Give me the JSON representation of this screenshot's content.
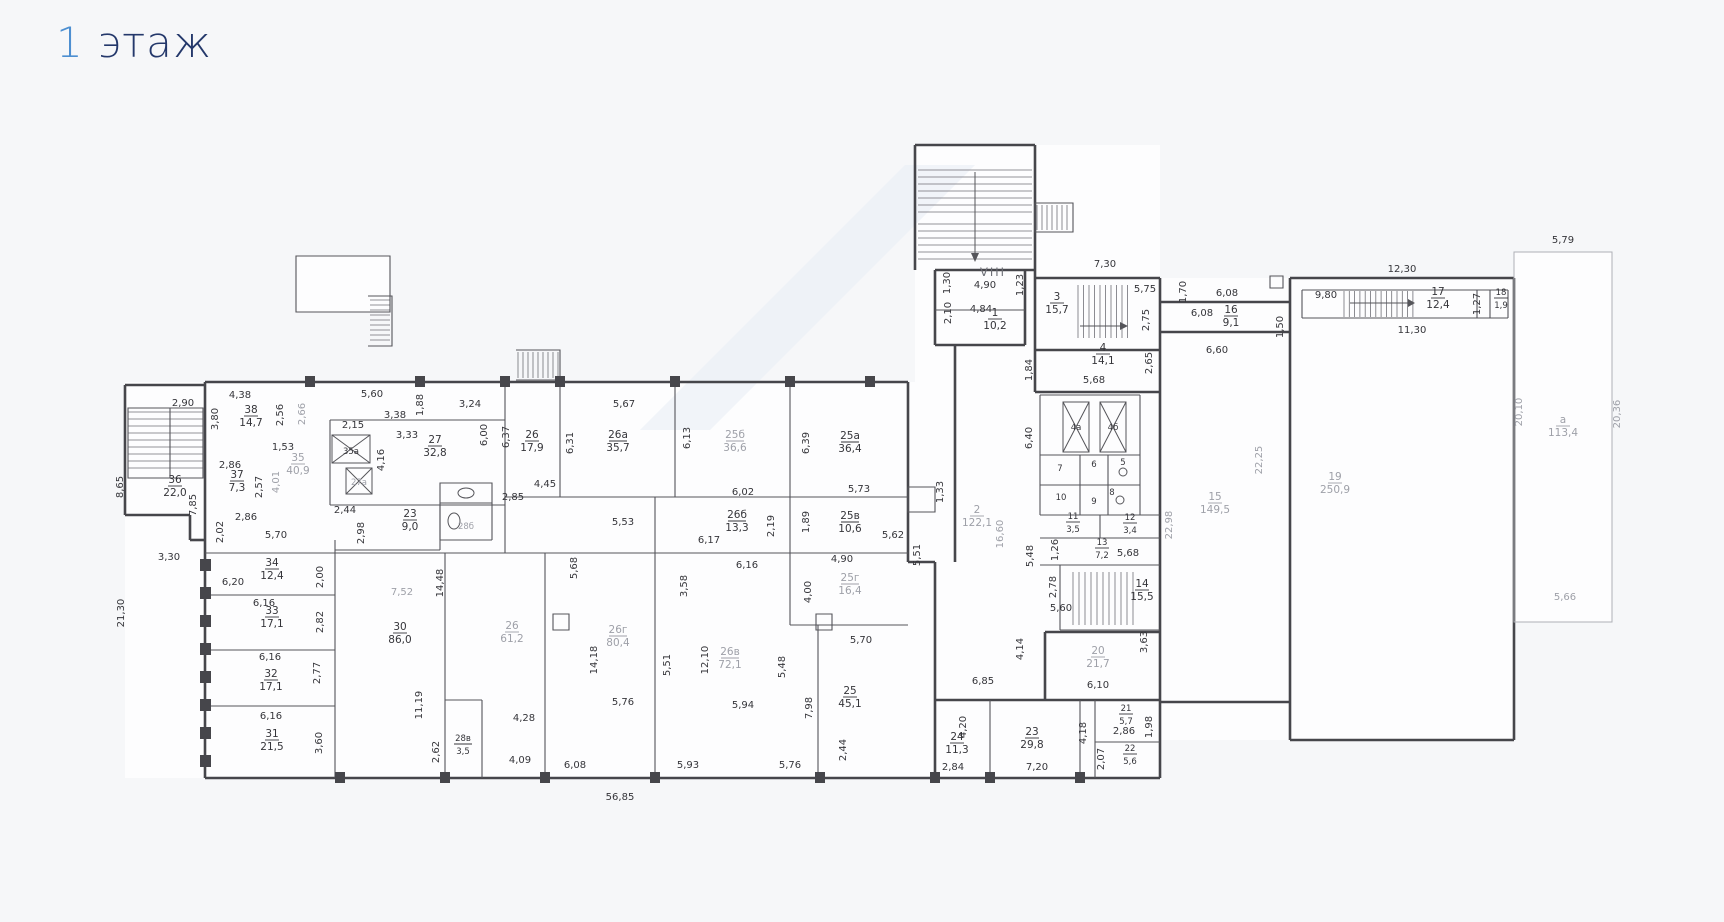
{
  "title": {
    "number": "1",
    "word": " этаж"
  },
  "colors": {
    "accent_blue": "#4d8fd1",
    "title_navy": "#24386b",
    "wall": "#46464b",
    "dim_text": "#35353a",
    "dim_text_light": "#9ea0a8"
  },
  "plan": {
    "rooms": [
      {
        "n": "36",
        "a": "22,0",
        "x": 175,
        "y": 483
      },
      {
        "n": "38",
        "a": "14,7",
        "x": 251,
        "y": 413
      },
      {
        "n": "37",
        "a": "7,3",
        "x": 237,
        "y": 478
      },
      {
        "n": "35",
        "a": "40,9",
        "x": 298,
        "y": 461,
        "l": 1
      },
      {
        "n": "35а",
        "a": null,
        "x": 351,
        "y": 454,
        "s": 1
      },
      {
        "n": "27а",
        "a": null,
        "x": 359,
        "y": 485,
        "s": 1,
        "l": 1
      },
      {
        "n": "27",
        "a": "32,8",
        "x": 435,
        "y": 443
      },
      {
        "n": "23",
        "a": "9,0",
        "x": 410,
        "y": 517
      },
      {
        "n": "28б",
        "a": null,
        "x": 466,
        "y": 529,
        "s": 1,
        "l": 1
      },
      {
        "n": "26",
        "a": "17,9",
        "x": 532,
        "y": 438
      },
      {
        "n": "26а",
        "a": "35,7",
        "x": 618,
        "y": 438
      },
      {
        "n": "25б",
        "a": "36,6",
        "x": 735,
        "y": 438,
        "l": 1
      },
      {
        "n": "25а",
        "a": "36,4",
        "x": 850,
        "y": 439
      },
      {
        "n": "26б",
        "a": "13,3",
        "x": 737,
        "y": 518
      },
      {
        "n": "25в",
        "a": "10,6",
        "x": 850,
        "y": 519
      },
      {
        "n": "25г",
        "a": "16,4",
        "x": 850,
        "y": 581,
        "l": 1
      },
      {
        "n": "34",
        "a": "12,4",
        "x": 272,
        "y": 566
      },
      {
        "n": "33",
        "a": "17,1",
        "x": 272,
        "y": 614
      },
      {
        "n": "32",
        "a": "17,1",
        "x": 271,
        "y": 677
      },
      {
        "n": "31",
        "a": "21,5",
        "x": 272,
        "y": 737
      },
      {
        "n": "30",
        "a": "86,0",
        "x": 400,
        "y": 630
      },
      {
        "n": "26",
        "a": "61,2",
        "x": 512,
        "y": 629,
        "l": 1
      },
      {
        "n": "26г",
        "a": "80,4",
        "x": 618,
        "y": 633,
        "l": 1
      },
      {
        "n": "26в",
        "a": "72,1",
        "x": 730,
        "y": 655,
        "l": 1
      },
      {
        "n": "28в",
        "a": "3,5",
        "x": 463,
        "y": 741,
        "s": 1
      },
      {
        "n": "25",
        "a": "45,1",
        "x": 850,
        "y": 694
      },
      {
        "n": "1",
        "a": "10,2",
        "x": 995,
        "y": 316
      },
      {
        "n": "3",
        "a": "15,7",
        "x": 1057,
        "y": 300
      },
      {
        "n": "4",
        "a": "14,1",
        "x": 1103,
        "y": 351
      },
      {
        "n": "2",
        "a": "122,1",
        "x": 977,
        "y": 513,
        "l": 1
      },
      {
        "n": "4а",
        "a": null,
        "x": 1076,
        "y": 430,
        "s": 1
      },
      {
        "n": "4б",
        "a": null,
        "x": 1113,
        "y": 430,
        "s": 1
      },
      {
        "n": "7",
        "a": null,
        "x": 1060,
        "y": 471,
        "s": 1
      },
      {
        "n": "6",
        "a": null,
        "x": 1094,
        "y": 467,
        "s": 1
      },
      {
        "n": "5",
        "a": null,
        "x": 1123,
        "y": 465,
        "s": 1
      },
      {
        "n": "10",
        "a": null,
        "x": 1061,
        "y": 500,
        "s": 1
      },
      {
        "n": "9",
        "a": null,
        "x": 1094,
        "y": 504,
        "s": 1
      },
      {
        "n": "8",
        "a": null,
        "x": 1112,
        "y": 495,
        "s": 1
      },
      {
        "n": "11",
        "a": "3,5",
        "x": 1073,
        "y": 519,
        "s": 1
      },
      {
        "n": "12",
        "a": "3,4",
        "x": 1130,
        "y": 520,
        "s": 1
      },
      {
        "n": "13",
        "a": "7,2",
        "x": 1102,
        "y": 545,
        "s": 1
      },
      {
        "n": "14",
        "a": "15,5",
        "x": 1142,
        "y": 587
      },
      {
        "n": "20",
        "a": "21,7",
        "x": 1098,
        "y": 654,
        "l": 1
      },
      {
        "n": "24",
        "a": "11,3",
        "x": 957,
        "y": 740
      },
      {
        "n": "23",
        "a": "29,8",
        "x": 1032,
        "y": 735
      },
      {
        "n": "21",
        "a": "5,7",
        "x": 1126,
        "y": 711,
        "s": 1
      },
      {
        "n": "22",
        "a": "5,6",
        "x": 1130,
        "y": 751,
        "s": 1
      },
      {
        "n": "16",
        "a": "9,1",
        "x": 1231,
        "y": 313
      },
      {
        "n": "17",
        "a": "12,4",
        "x": 1438,
        "y": 295
      },
      {
        "n": "18",
        "a": "1,9",
        "x": 1501,
        "y": 295,
        "s": 1
      },
      {
        "n": "15",
        "a": "149,5",
        "x": 1215,
        "y": 500,
        "l": 1
      },
      {
        "n": "19",
        "a": "250,9",
        "x": 1335,
        "y": 480,
        "l": 1
      },
      {
        "n": "а",
        "a": "113,4",
        "x": 1563,
        "y": 423,
        "l": 1
      }
    ],
    "dims": [
      {
        "t": "2,90",
        "x": 183,
        "y": 406
      },
      {
        "t": "4,38",
        "x": 240,
        "y": 398
      },
      {
        "t": "3,80",
        "x": 218,
        "y": 419,
        "r": 1
      },
      {
        "t": "2,56",
        "x": 283,
        "y": 415,
        "r": 1
      },
      {
        "t": "2,66",
        "x": 305,
        "y": 414,
        "r": 1,
        "l": 1
      },
      {
        "t": "5,60",
        "x": 372,
        "y": 397
      },
      {
        "t": "3,38",
        "x": 395,
        "y": 418
      },
      {
        "t": "1,88",
        "x": 423,
        "y": 405,
        "r": 1
      },
      {
        "t": "3,24",
        "x": 470,
        "y": 407
      },
      {
        "t": "2,15",
        "x": 353,
        "y": 428
      },
      {
        "t": "3,33",
        "x": 407,
        "y": 438
      },
      {
        "t": "1,53",
        "x": 283,
        "y": 450
      },
      {
        "t": "2,86",
        "x": 230,
        "y": 468
      },
      {
        "t": "2,57",
        "x": 262,
        "y": 487,
        "r": 1
      },
      {
        "t": "4,01",
        "x": 279,
        "y": 482,
        "r": 1,
        "l": 1
      },
      {
        "t": "4,16",
        "x": 384,
        "y": 460,
        "r": 1
      },
      {
        "t": "8,65",
        "x": 123,
        "y": 487,
        "r": 1
      },
      {
        "t": "7,85",
        "x": 196,
        "y": 505,
        "r": 1
      },
      {
        "t": "2,02",
        "x": 223,
        "y": 532,
        "r": 1
      },
      {
        "t": "2,86",
        "x": 246,
        "y": 520
      },
      {
        "t": "5,70",
        "x": 276,
        "y": 538
      },
      {
        "t": "3,30",
        "x": 169,
        "y": 560
      },
      {
        "t": "21,30",
        "x": 124,
        "y": 613,
        "r": 1
      },
      {
        "t": "6,20",
        "x": 233,
        "y": 585
      },
      {
        "t": "2,00",
        "x": 323,
        "y": 577,
        "r": 1
      },
      {
        "t": "7,52",
        "x": 402,
        "y": 595,
        "l": 1
      },
      {
        "t": "6,16",
        "x": 264,
        "y": 606
      },
      {
        "t": "2,82",
        "x": 323,
        "y": 622,
        "r": 1
      },
      {
        "t": "6,16",
        "x": 270,
        "y": 660
      },
      {
        "t": "2,77",
        "x": 320,
        "y": 673,
        "r": 1
      },
      {
        "t": "6,16",
        "x": 271,
        "y": 719
      },
      {
        "t": "3,60",
        "x": 322,
        "y": 743,
        "r": 1
      },
      {
        "t": "2,44",
        "x": 345,
        "y": 513
      },
      {
        "t": "2,98",
        "x": 364,
        "y": 533,
        "r": 1
      },
      {
        "t": "6,00",
        "x": 487,
        "y": 435,
        "r": 1
      },
      {
        "t": "6,37",
        "x": 509,
        "y": 437,
        "r": 1
      },
      {
        "t": "2,85",
        "x": 513,
        "y": 500
      },
      {
        "t": "4,45",
        "x": 545,
        "y": 487
      },
      {
        "t": "5,67",
        "x": 624,
        "y": 407
      },
      {
        "t": "6,31",
        "x": 573,
        "y": 443,
        "r": 1
      },
      {
        "t": "6,13",
        "x": 690,
        "y": 438,
        "r": 1
      },
      {
        "t": "6,39",
        "x": 809,
        "y": 443,
        "r": 1
      },
      {
        "t": "6,02",
        "x": 743,
        "y": 495
      },
      {
        "t": "5,73",
        "x": 859,
        "y": 492
      },
      {
        "t": "5,53",
        "x": 623,
        "y": 525
      },
      {
        "t": "2,19",
        "x": 774,
        "y": 526,
        "r": 1
      },
      {
        "t": "1,89",
        "x": 809,
        "y": 522,
        "r": 1
      },
      {
        "t": "6,17",
        "x": 709,
        "y": 543
      },
      {
        "t": "5,62",
        "x": 893,
        "y": 538
      },
      {
        "t": "5,51",
        "x": 920,
        "y": 555,
        "r": 1
      },
      {
        "t": "4,90",
        "x": 842,
        "y": 562
      },
      {
        "t": "6,16",
        "x": 747,
        "y": 568
      },
      {
        "t": "4,00",
        "x": 811,
        "y": 592,
        "r": 1
      },
      {
        "t": "1,33",
        "x": 943,
        "y": 492,
        "r": 1
      },
      {
        "t": "14,48",
        "x": 443,
        "y": 583,
        "r": 1
      },
      {
        "t": "5,68",
        "x": 577,
        "y": 568,
        "r": 1
      },
      {
        "t": "3,58",
        "x": 687,
        "y": 586,
        "r": 1
      },
      {
        "t": "14,18",
        "x": 597,
        "y": 660,
        "r": 1
      },
      {
        "t": "5,51",
        "x": 670,
        "y": 665,
        "r": 1
      },
      {
        "t": "12,10",
        "x": 708,
        "y": 660,
        "r": 1
      },
      {
        "t": "5,48",
        "x": 785,
        "y": 667,
        "r": 1
      },
      {
        "t": "11,19",
        "x": 422,
        "y": 705,
        "r": 1
      },
      {
        "t": "4,28",
        "x": 524,
        "y": 721
      },
      {
        "t": "5,76",
        "x": 623,
        "y": 705
      },
      {
        "t": "5,94",
        "x": 743,
        "y": 708
      },
      {
        "t": "7,98",
        "x": 812,
        "y": 708,
        "r": 1
      },
      {
        "t": "2,62",
        "x": 439,
        "y": 752,
        "r": 1
      },
      {
        "t": "4,09",
        "x": 520,
        "y": 763
      },
      {
        "t": "6,08",
        "x": 575,
        "y": 768
      },
      {
        "t": "5,93",
        "x": 688,
        "y": 768
      },
      {
        "t": "5,76",
        "x": 790,
        "y": 768
      },
      {
        "t": "2,44",
        "x": 846,
        "y": 750,
        "r": 1
      },
      {
        "t": "56,85",
        "x": 620,
        "y": 800
      },
      {
        "t": "5,70",
        "x": 861,
        "y": 643
      },
      {
        "t": "6,85",
        "x": 983,
        "y": 684
      },
      {
        "t": "VIII",
        "x": 993,
        "y": 276,
        "b": 1
      },
      {
        "t": "1,30",
        "x": 950,
        "y": 283,
        "r": 1
      },
      {
        "t": "4,90",
        "x": 985,
        "y": 288
      },
      {
        "t": "1,23",
        "x": 1023,
        "y": 285,
        "r": 1
      },
      {
        "t": "2,10",
        "x": 951,
        "y": 313,
        "r": 1
      },
      {
        "t": "4,84",
        "x": 981,
        "y": 312
      },
      {
        "t": "7,30",
        "x": 1105,
        "y": 267
      },
      {
        "t": "5,75",
        "x": 1145,
        "y": 292
      },
      {
        "t": "2,75",
        "x": 1149,
        "y": 320,
        "r": 1
      },
      {
        "t": "2,65",
        "x": 1152,
        "y": 363,
        "r": 1
      },
      {
        "t": "5,68",
        "x": 1094,
        "y": 383
      },
      {
        "t": "1,84",
        "x": 1032,
        "y": 370,
        "r": 1
      },
      {
        "t": "6,40",
        "x": 1032,
        "y": 438,
        "r": 1
      },
      {
        "t": "16,60",
        "x": 1003,
        "y": 534,
        "r": 1,
        "l": 1
      },
      {
        "t": "5,48",
        "x": 1033,
        "y": 556,
        "r": 1
      },
      {
        "t": "1,26",
        "x": 1058,
        "y": 550,
        "r": 1
      },
      {
        "t": "5,68",
        "x": 1128,
        "y": 556
      },
      {
        "t": "2,78",
        "x": 1056,
        "y": 587,
        "r": 1
      },
      {
        "t": "5,60",
        "x": 1061,
        "y": 611
      },
      {
        "t": "4,14",
        "x": 1023,
        "y": 649,
        "r": 1
      },
      {
        "t": "3,63",
        "x": 1147,
        "y": 642,
        "r": 1
      },
      {
        "t": "6,10",
        "x": 1098,
        "y": 688
      },
      {
        "t": "4,20",
        "x": 966,
        "y": 727,
        "r": 1
      },
      {
        "t": "2,84",
        "x": 953,
        "y": 770
      },
      {
        "t": "7,20",
        "x": 1037,
        "y": 770
      },
      {
        "t": "4,18",
        "x": 1086,
        "y": 733,
        "r": 1
      },
      {
        "t": "2,86",
        "x": 1124,
        "y": 734
      },
      {
        "t": "1,98",
        "x": 1152,
        "y": 727,
        "r": 1
      },
      {
        "t": "2,07",
        "x": 1104,
        "y": 759,
        "r": 1
      },
      {
        "t": "1,70",
        "x": 1186,
        "y": 292,
        "r": 1
      },
      {
        "t": "6,08",
        "x": 1227,
        "y": 296
      },
      {
        "t": "6,08",
        "x": 1202,
        "y": 316
      },
      {
        "t": "1,50",
        "x": 1283,
        "y": 327,
        "r": 1
      },
      {
        "t": "6,60",
        "x": 1217,
        "y": 353
      },
      {
        "t": "12,30",
        "x": 1402,
        "y": 272
      },
      {
        "t": "9,80",
        "x": 1326,
        "y": 298
      },
      {
        "t": "1,27",
        "x": 1480,
        "y": 304,
        "r": 1
      },
      {
        "t": "11,30",
        "x": 1412,
        "y": 333
      },
      {
        "t": "22,25",
        "x": 1262,
        "y": 460,
        "r": 1,
        "l": 1
      },
      {
        "t": "22,98",
        "x": 1172,
        "y": 525,
        "r": 1,
        "l": 1
      },
      {
        "t": "5,79",
        "x": 1563,
        "y": 243
      },
      {
        "t": "20,10",
        "x": 1522,
        "y": 412,
        "r": 1,
        "l": 1
      },
      {
        "t": "20,36",
        "x": 1620,
        "y": 414,
        "r": 1,
        "l": 1
      },
      {
        "t": "5,66",
        "x": 1565,
        "y": 600,
        "l": 1
      }
    ]
  }
}
